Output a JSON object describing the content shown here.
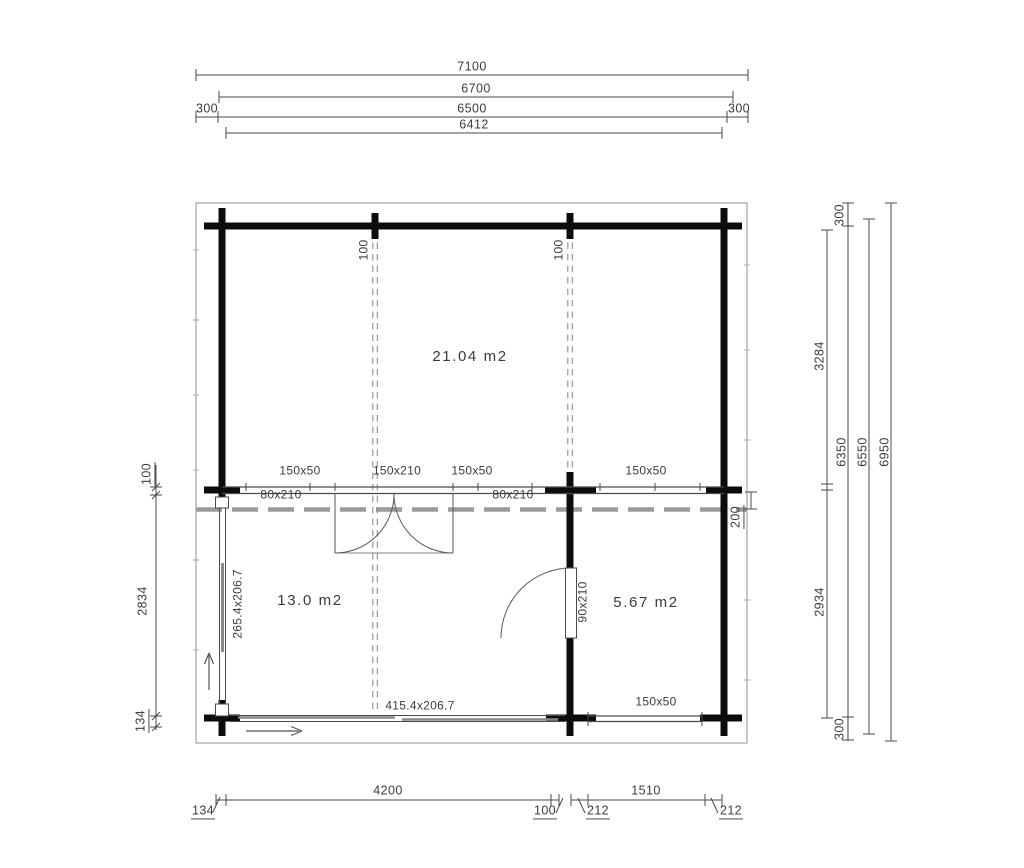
{
  "dims": {
    "top": {
      "d7100": "7100",
      "d6700": "6700",
      "d300l": "300",
      "d6500": "6500",
      "d300r": "300",
      "d6412": "6412"
    },
    "bottom": {
      "d134": "134",
      "d4200": "4200",
      "d100": "100",
      "d212a": "212",
      "d1510": "1510",
      "d212b": "212"
    },
    "left": {
      "d100": "100",
      "d2834": "2834",
      "d134": "134"
    },
    "right": {
      "d300t": "300",
      "d3284": "3284",
      "d6350": "6350",
      "d6550": "6550",
      "d6950": "6950",
      "d200": "200",
      "d2934": "2934",
      "d300b": "300"
    }
  },
  "plan": {
    "rooms": {
      "main": "21.04 m2",
      "terrace": "13.0 m2",
      "storage": "5.67 m2"
    },
    "openings": {
      "window_a": "150x50",
      "door_double": "150x210",
      "window_b": "150x50",
      "window_c": "150x50",
      "door_a": "80x210",
      "door_b": "80x210",
      "door_storage": "90x210",
      "slider_left": "265.4x206.7",
      "slider_bottom": "415.4x206.7",
      "window_bottom": "150x50"
    },
    "beams": {
      "left": "100",
      "right": "100"
    }
  }
}
